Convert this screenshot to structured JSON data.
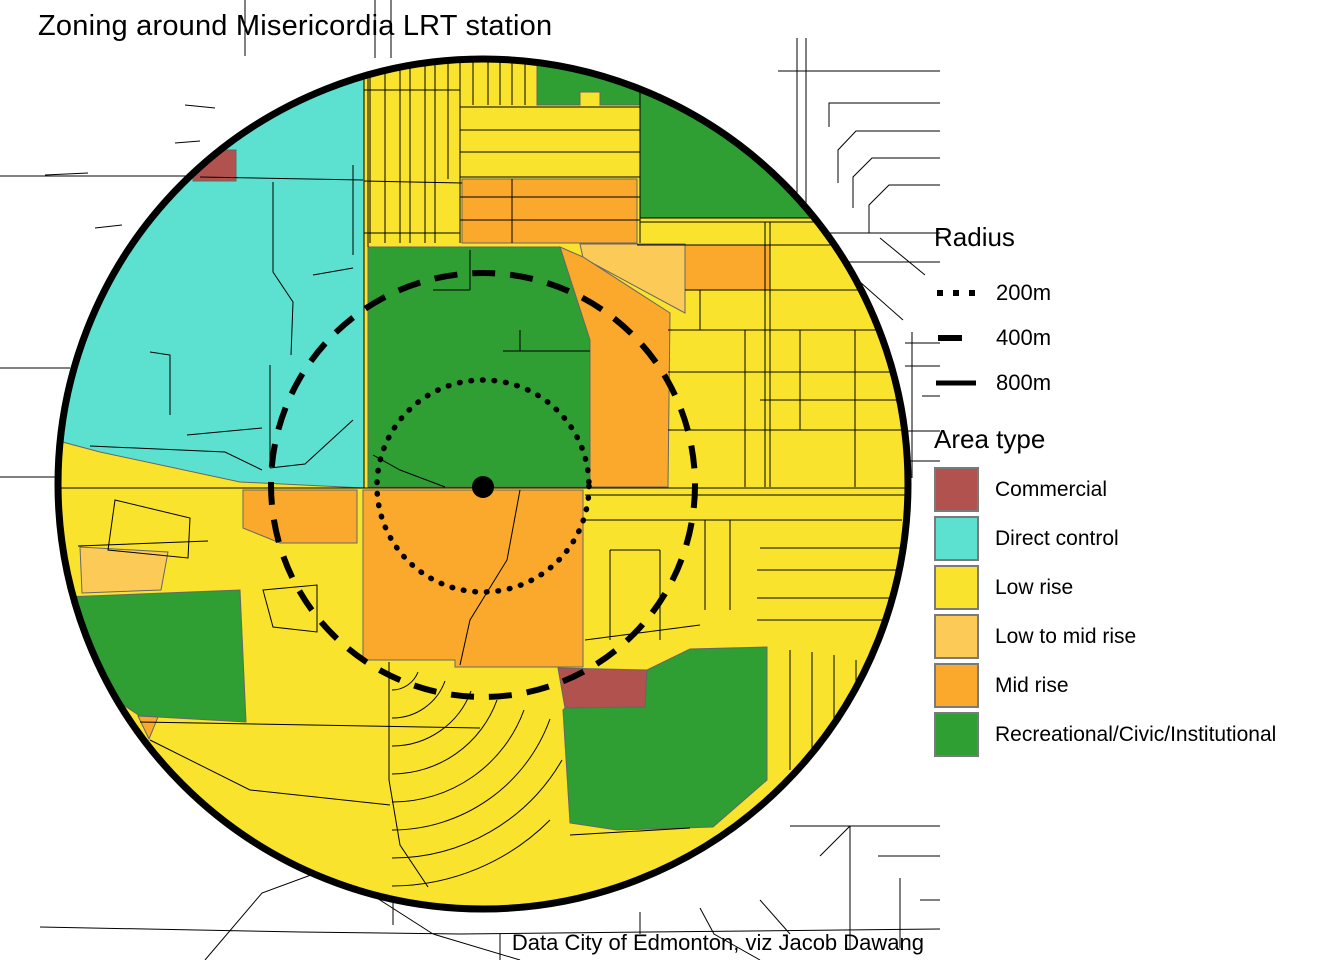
{
  "title": "Zoning around Misericordia LRT station",
  "attribution": "Data City of Edmonton, viz Jacob Dawang",
  "radius_legend": {
    "title": "Radius",
    "items": [
      {
        "label": "200m",
        "style": "dotted"
      },
      {
        "label": "400m",
        "style": "dashed"
      },
      {
        "label": "800m",
        "style": "solid"
      }
    ]
  },
  "area_legend": {
    "title": "Area type",
    "swatch_border_color": "#7a7a7a",
    "items": [
      {
        "label": "Commercial",
        "color": "#b2524e"
      },
      {
        "label": "Direct control",
        "color": "#5ce1d1"
      },
      {
        "label": "Low rise",
        "color": "#f9e32d"
      },
      {
        "label": "Low to mid rise",
        "color": "#fbca57"
      },
      {
        "label": "Mid rise",
        "color": "#fba92d"
      },
      {
        "label": "Recreational/Civic/Institutional",
        "color": "#2f9e33"
      }
    ]
  },
  "map": {
    "ring_color": "#000000",
    "road_color": "#000000",
    "station_dot_color": "#000000"
  }
}
